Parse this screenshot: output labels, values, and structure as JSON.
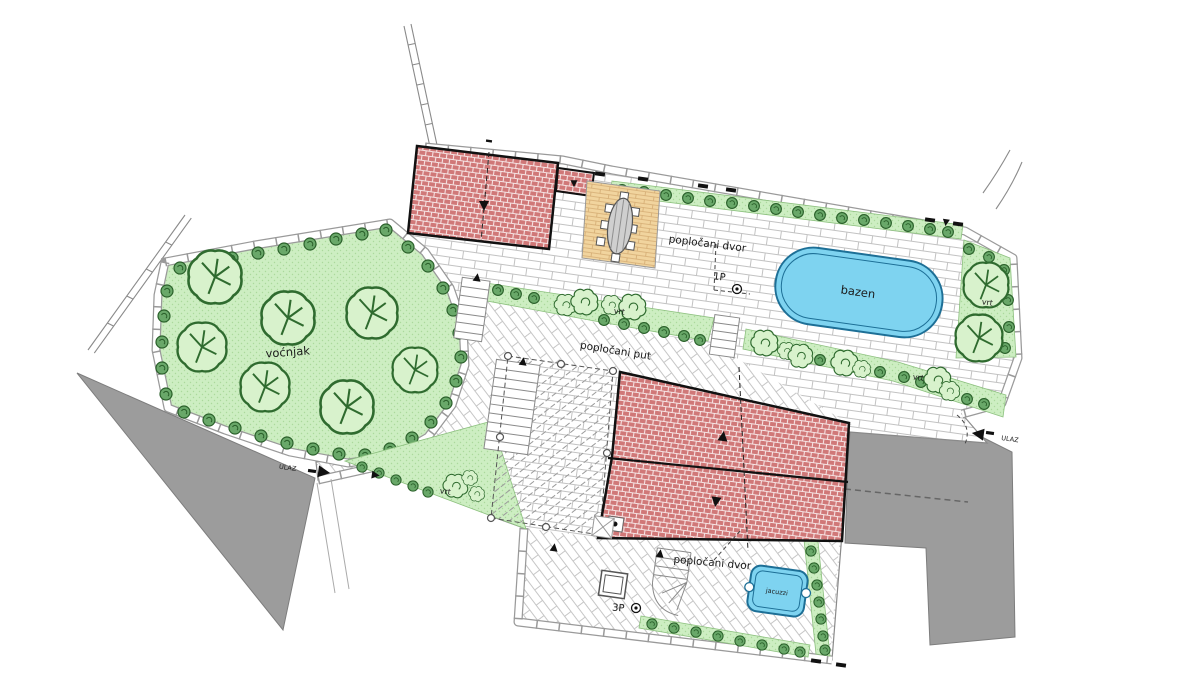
{
  "plan": {
    "area_labels": {
      "orchard": "voćnjak",
      "upper_courtyard": "popločani dvor",
      "lower_courtyard": "popločani dvor",
      "paved_path": "popločani put",
      "pool": "bazen",
      "jacuzzi": "jacuzzi",
      "garden_middle": "vrt",
      "garden_right": "vrt",
      "garden_south": "vrt",
      "garden_entrance": "vrt"
    },
    "markers": {
      "parking_upper": "1P",
      "parking_lower": "3P",
      "entrance_west": "ULAZ",
      "entrance_east": "ULAZ"
    },
    "colors": {
      "grass_green": "#cdeec2",
      "bush_green": "#69a869",
      "tree_outline_green": "#2f6b2f",
      "roof_red": "#d07878",
      "pool_blue": "#7ed3f0",
      "pool_outline": "#1d6f96",
      "road_gray": "#9c9c9c",
      "terrace_tan": "#f1d49e",
      "paving_joint_gray": "#c2c2c2"
    }
  }
}
